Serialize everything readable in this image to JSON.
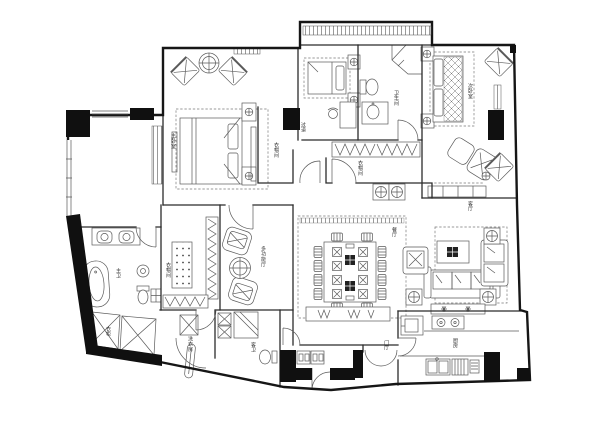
{
  "meta": {
    "drawing_type": "apartment-floor-plan"
  },
  "colors": {
    "paper": "#ffffff",
    "wall": "#161616",
    "furniture_line": "#5a5a5a",
    "label": "#333333"
  },
  "rooms": {
    "master_bedroom": {
      "label": "主卧室"
    },
    "master_closet": {
      "label": "衣帽间"
    },
    "hallway": {
      "label": "过道"
    },
    "bathroom": {
      "label": "卫生间"
    },
    "second_bedroom": {
      "label": "次卧室"
    },
    "corridor_closet": {
      "label": "衣帽间"
    },
    "dining_room": {
      "label": "餐厅"
    },
    "living_room": {
      "label": "客厅"
    },
    "kitchen": {
      "label": "厨房"
    },
    "master_bath": {
      "label": "主卫"
    },
    "wardrobe": {
      "label": "衣柜"
    },
    "walkin_closet": {
      "label": "衣帽间"
    },
    "multipurpose_room": {
      "label": "多功能厅"
    },
    "laundry": {
      "label": "洗衣房"
    },
    "guest_bath": {
      "label": "客卫"
    },
    "foyer": {
      "label": "门厅"
    }
  }
}
